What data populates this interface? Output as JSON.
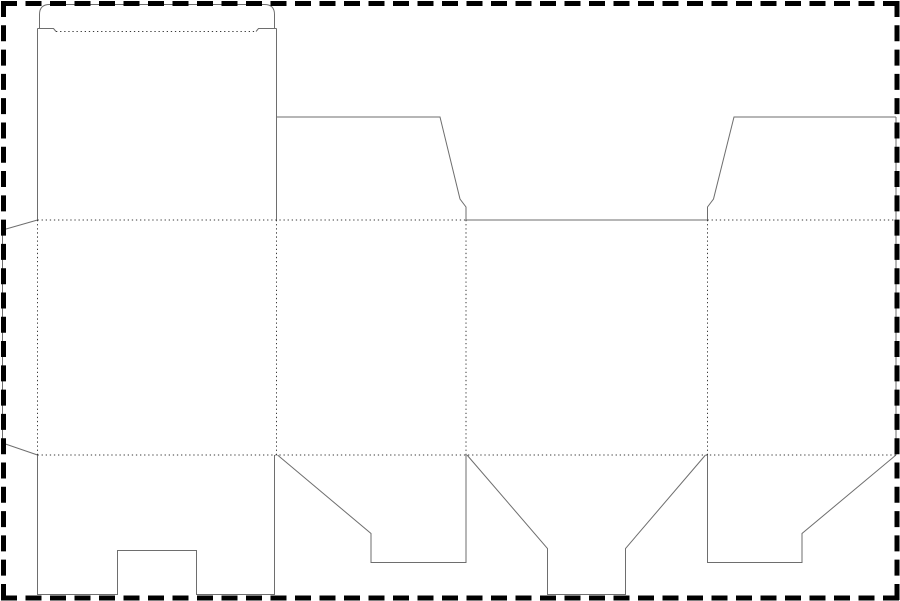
{
  "page": {
    "width": 900,
    "height": 601,
    "background": "#ffffff"
  },
  "border": {
    "color": "#000000",
    "width": 5,
    "dash_horizontal": "16 8.5",
    "dash_vertical": "16 8.29"
  },
  "dieline": {
    "cut": {
      "color": "#6e6e6e",
      "width": 1,
      "path": "M39.5,28.5 V14.5 Q39.5,4.5 49.5,4.5 H264.5 Q274.5,4.5 274.5,14.5 V28.5 M37.5,28.5 H53.5 L56,31.5 M276.5,28.5 H258.5 L256,31.5 M37.5,28.5 V220 M276.5,28.5 V220 M276.5,117 H440 L460,199 L466,207 V220 M896,117 H734 L713.5,199 L707.5,207 V220 M896,117 V455 M466,220 H707.5 M37.5,220 L2.5,230 V443 L37.5,455 M37.5,455 V594.5 H117.5 V550.5 H196.5 V594.5 H274.5 V455 M277.5,455 L371,533.5 V562.5 H466 V455 M467,455 L547.5,548.5 V594.5 H625.5 V548.5 L705.5,455 M707.5,455 V562.5 H802 V533.5 L896,455"
    },
    "fold": {
      "color": "#3a3a3a",
      "width": 1,
      "dash": "1.3 2.8",
      "path": "M56,31.5 H256 M37.5,220 H466 M707.5,220 H896 M37.5,455 H896 M37.5,220 V455 M276.5,220 V455 M466,220 V455 M707.5,220 V455"
    }
  }
}
